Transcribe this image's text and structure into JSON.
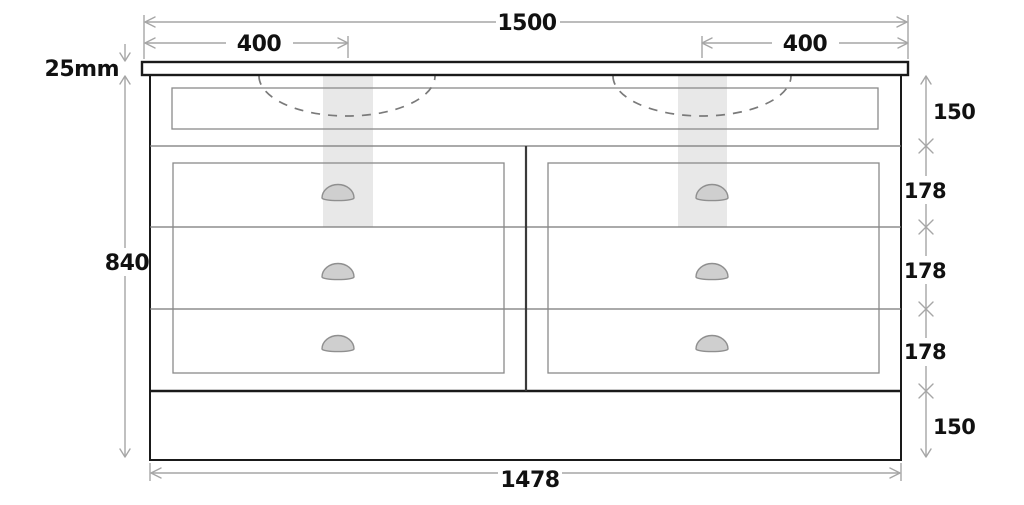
{
  "diagram": {
    "type": "technical-drawing",
    "subject": "double-basin vanity unit, front elevation with dimensions",
    "units": "mm",
    "labels": {
      "top_width": "1500",
      "left_basin_offset": "400",
      "right_basin_offset": "400",
      "worktop_thickness": "25mm",
      "body_height": "840",
      "top_rail_height": "150",
      "drawer1_height": "178",
      "drawer2_height": "178",
      "drawer3_height": "178",
      "plinth_height": "150",
      "body_width": "1478"
    },
    "colors": {
      "outline": "#1a1a1a",
      "panel_line": "#8a8a8a",
      "dimension_line": "#a6a6a6",
      "label_text": "#111111",
      "plumbing_zone": "#e8e8e8",
      "handle_fill": "#cfcfcf",
      "sink_dash": "#7a7a7a",
      "background": "#ffffff"
    }
  }
}
